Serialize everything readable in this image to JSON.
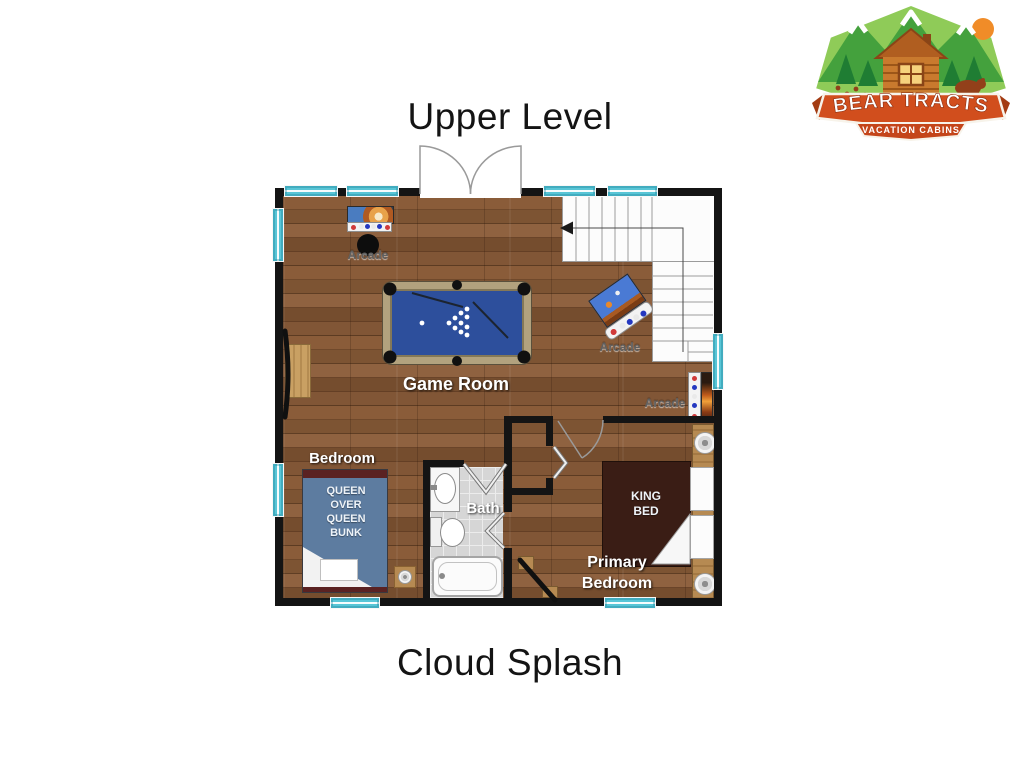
{
  "titles": {
    "upper": "Upper Level",
    "lower": "Cloud Splash"
  },
  "logo": {
    "brand": "BEAR TRACTS",
    "tagline": "VACATION CABINS"
  },
  "rooms": {
    "game_room": "Game Room",
    "bedroom": "Bedroom",
    "bath": "Bath",
    "primary_bedroom": "Primary\nBedroom"
  },
  "furniture": {
    "arcade_top": "Arcade",
    "arcade_middle": "Arcade",
    "arcade_right": "Arcade",
    "bunk_bed": "QUEEN\nOVER\nQUEEN\nBUNK",
    "king_bed": "KING\nBED"
  },
  "colors": {
    "wall": "#141414",
    "window_teal": "#58c5d6",
    "wood_floor": "#7b5232",
    "pool_felt": "#2d4f9c",
    "bunk_bed_blue": "#5d7ca0",
    "king_bed_brown": "#3a1d15",
    "bath_tile": "#d6d6d6",
    "logo_banner_orange": "#d14e1d",
    "logo_green": "#44a13d"
  }
}
